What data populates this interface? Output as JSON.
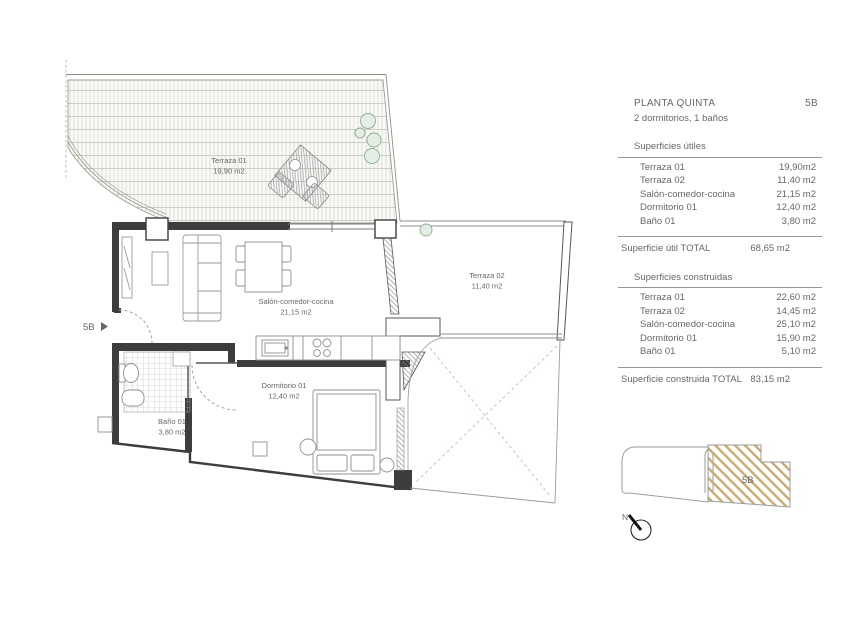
{
  "header": {
    "title": "PLANTA QUINTA",
    "unit": "5B",
    "subtitle": "2 dormitorios, 1 baños"
  },
  "surfaces_useful": {
    "heading": "Superficies útiles",
    "rows": [
      {
        "label": "Terraza 01",
        "value": "19,90m2"
      },
      {
        "label": "Terraza 02",
        "value": "11,40 m2"
      },
      {
        "label": "Salón-comedor-cocina",
        "value": "21,15 m2"
      },
      {
        "label": "Dormitorio 01",
        "value": "12,40 m2"
      },
      {
        "label": "Baño 01",
        "value": "3,80 m2"
      }
    ],
    "total": {
      "label": "Superficie útil TOTAL",
      "value": "68,65 m2"
    }
  },
  "surfaces_built": {
    "heading": "Superficies construidas",
    "rows": [
      {
        "label": "Terraza 01",
        "value": "22,60 m2"
      },
      {
        "label": "Terraza 02",
        "value": "14,45 m2"
      },
      {
        "label": "Salón-comedor-cocina",
        "value": "25,10 m2"
      },
      {
        "label": "Dormitorio 01",
        "value": "15,90 m2"
      },
      {
        "label": "Baño 01",
        "value": "5,10 m2"
      }
    ],
    "total": {
      "label": "Superficie construida TOTAL",
      "value": "83,15 m2"
    }
  },
  "plan": {
    "rooms": [
      {
        "name": "Terraza 01",
        "area": "19,90 m2"
      },
      {
        "name": "Terraza 02",
        "area": "11,40 m2"
      },
      {
        "name": "Salón-comedor-cocina",
        "area": "21,15 m2"
      },
      {
        "name": "Dormitorio 01",
        "area": "12,40 m2"
      },
      {
        "name": "Baño 01",
        "area": "3,80 m2"
      }
    ],
    "entrance_label": "5B"
  },
  "key_plan": {
    "unit_label": "5B"
  },
  "compass": {
    "north_label": "N"
  },
  "colors": {
    "text_gray": "#66676a",
    "hatch_gold": "#c9a96e",
    "plant_green": "#8fae8f",
    "deck_line": "#ccd1c6"
  }
}
